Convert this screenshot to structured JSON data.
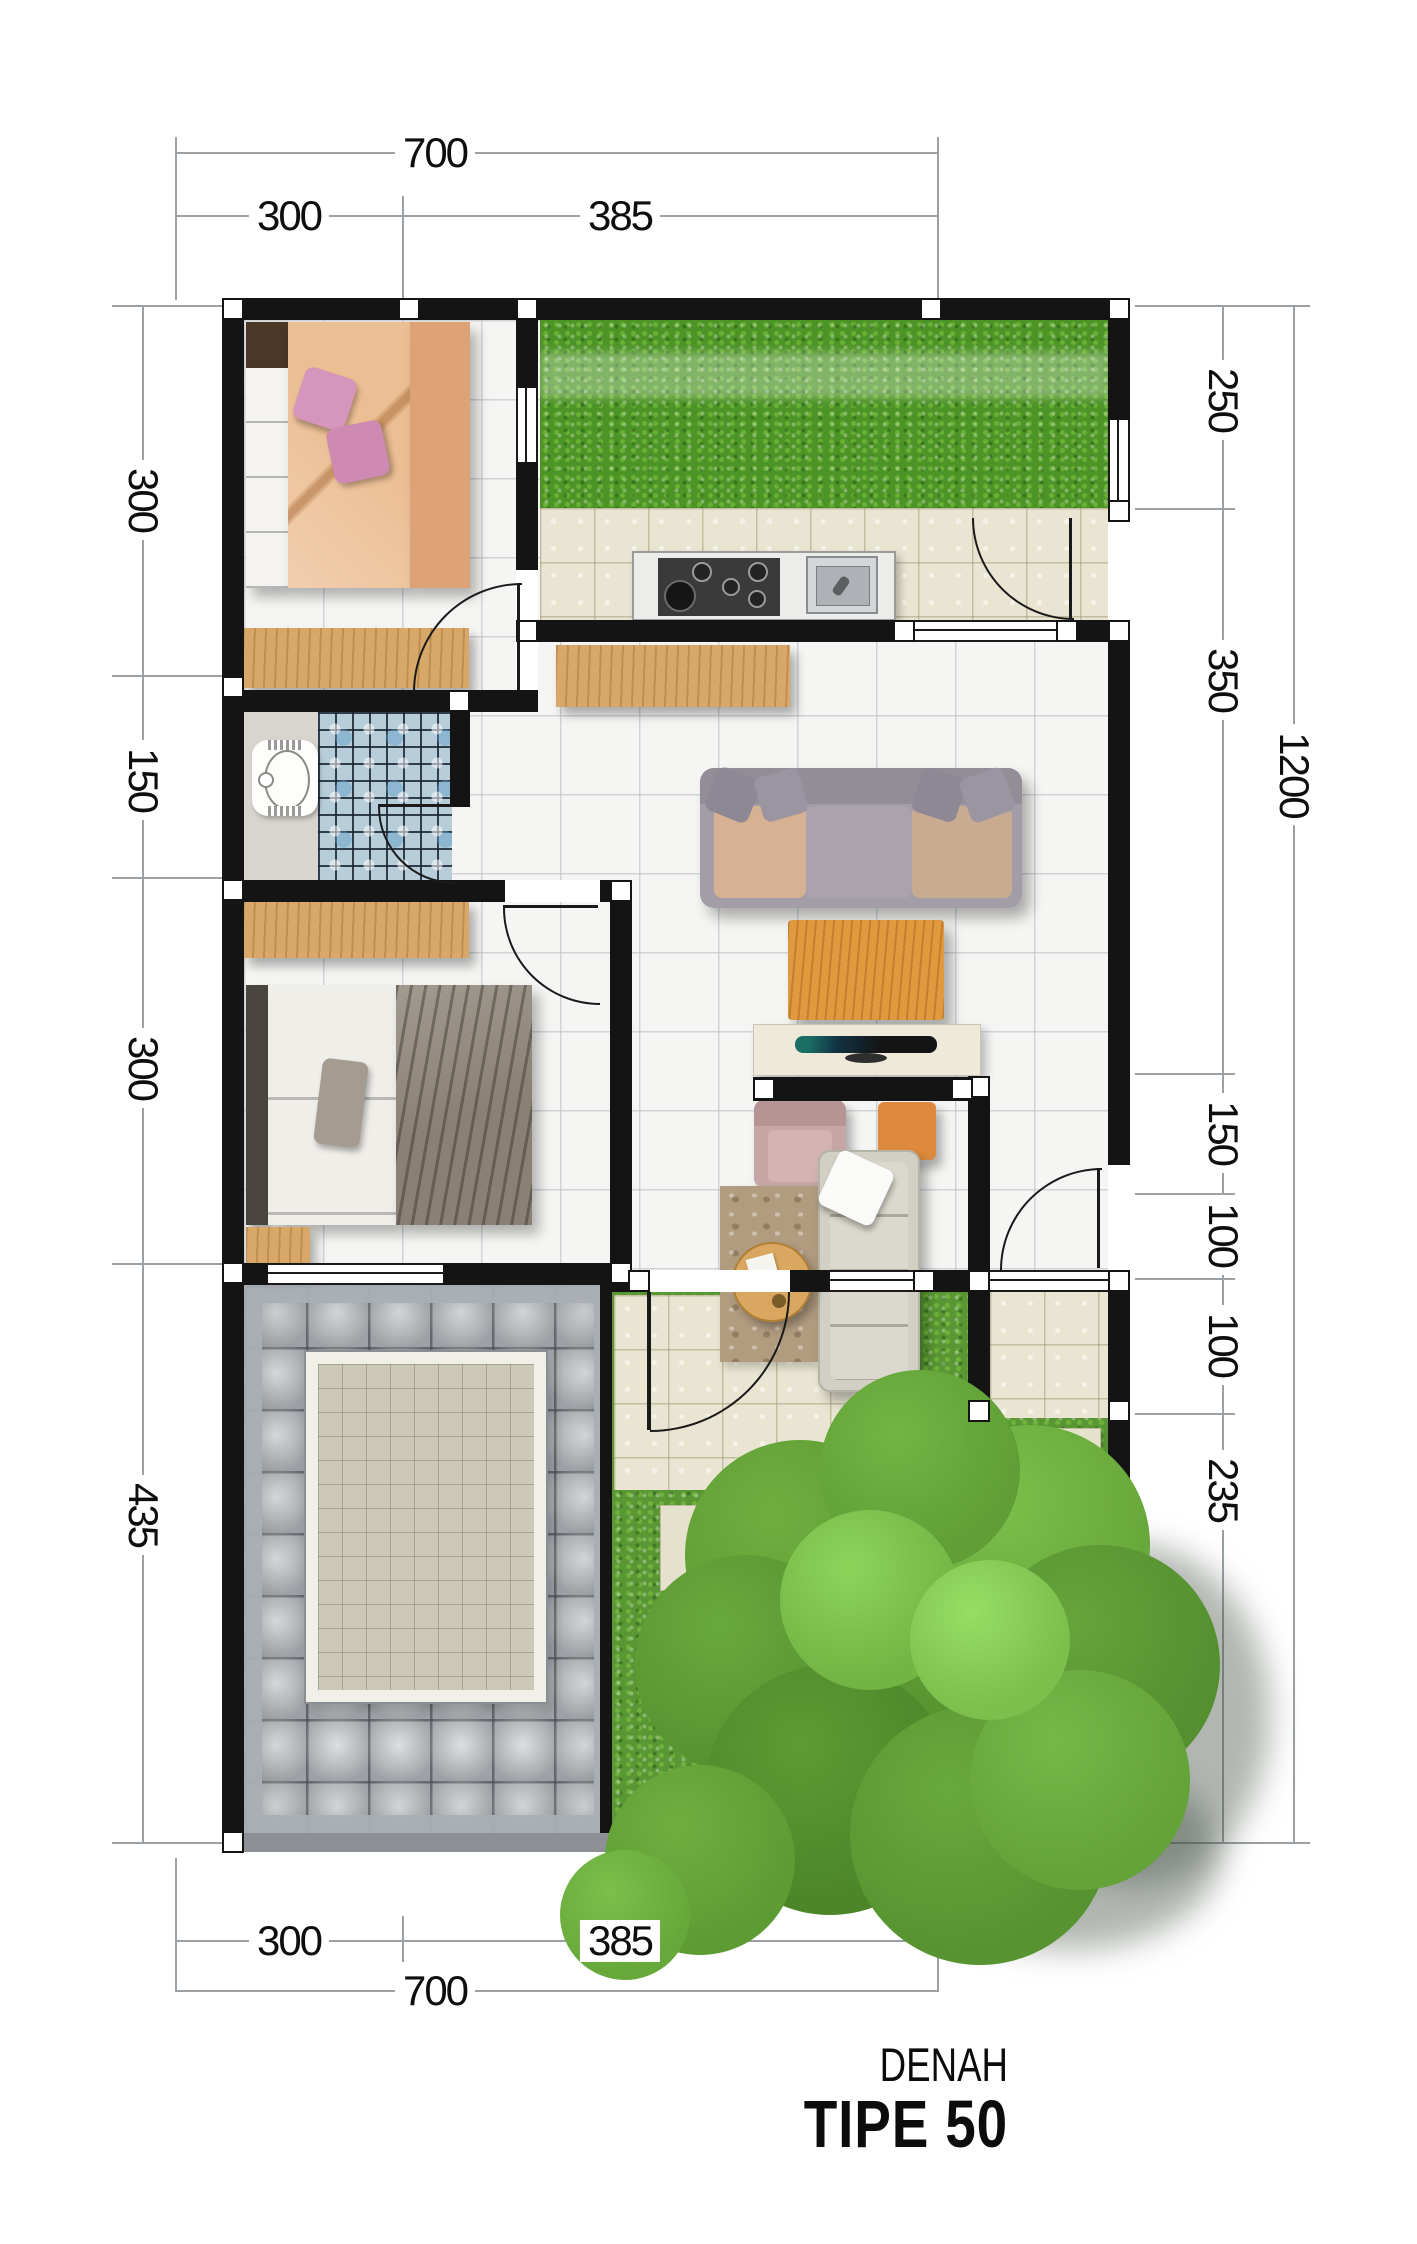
{
  "title": {
    "subtitle": "DENAH",
    "main": "TIPE 50"
  },
  "dimensions": {
    "top": {
      "overall": "700",
      "segments": [
        "300",
        "385"
      ]
    },
    "bottom": {
      "overall": "700",
      "segments": [
        "300",
        "385"
      ]
    },
    "left": {
      "segments": [
        "300",
        "150",
        "300",
        "435"
      ]
    },
    "right": {
      "overall": "1200",
      "segments": [
        "250",
        "350",
        "150",
        "100",
        "100",
        "235"
      ]
    }
  },
  "plan": {
    "type": "house-floor-plan",
    "colors": {
      "wall": "#141414",
      "grass": "#4d9427",
      "beige_tile": "#e9e5d2",
      "white_tile": "#f5f5f3",
      "mosaic_blue": "#b7cdd9",
      "wood": "#d8a868",
      "carport_paving": "#b4b8bc"
    }
  }
}
